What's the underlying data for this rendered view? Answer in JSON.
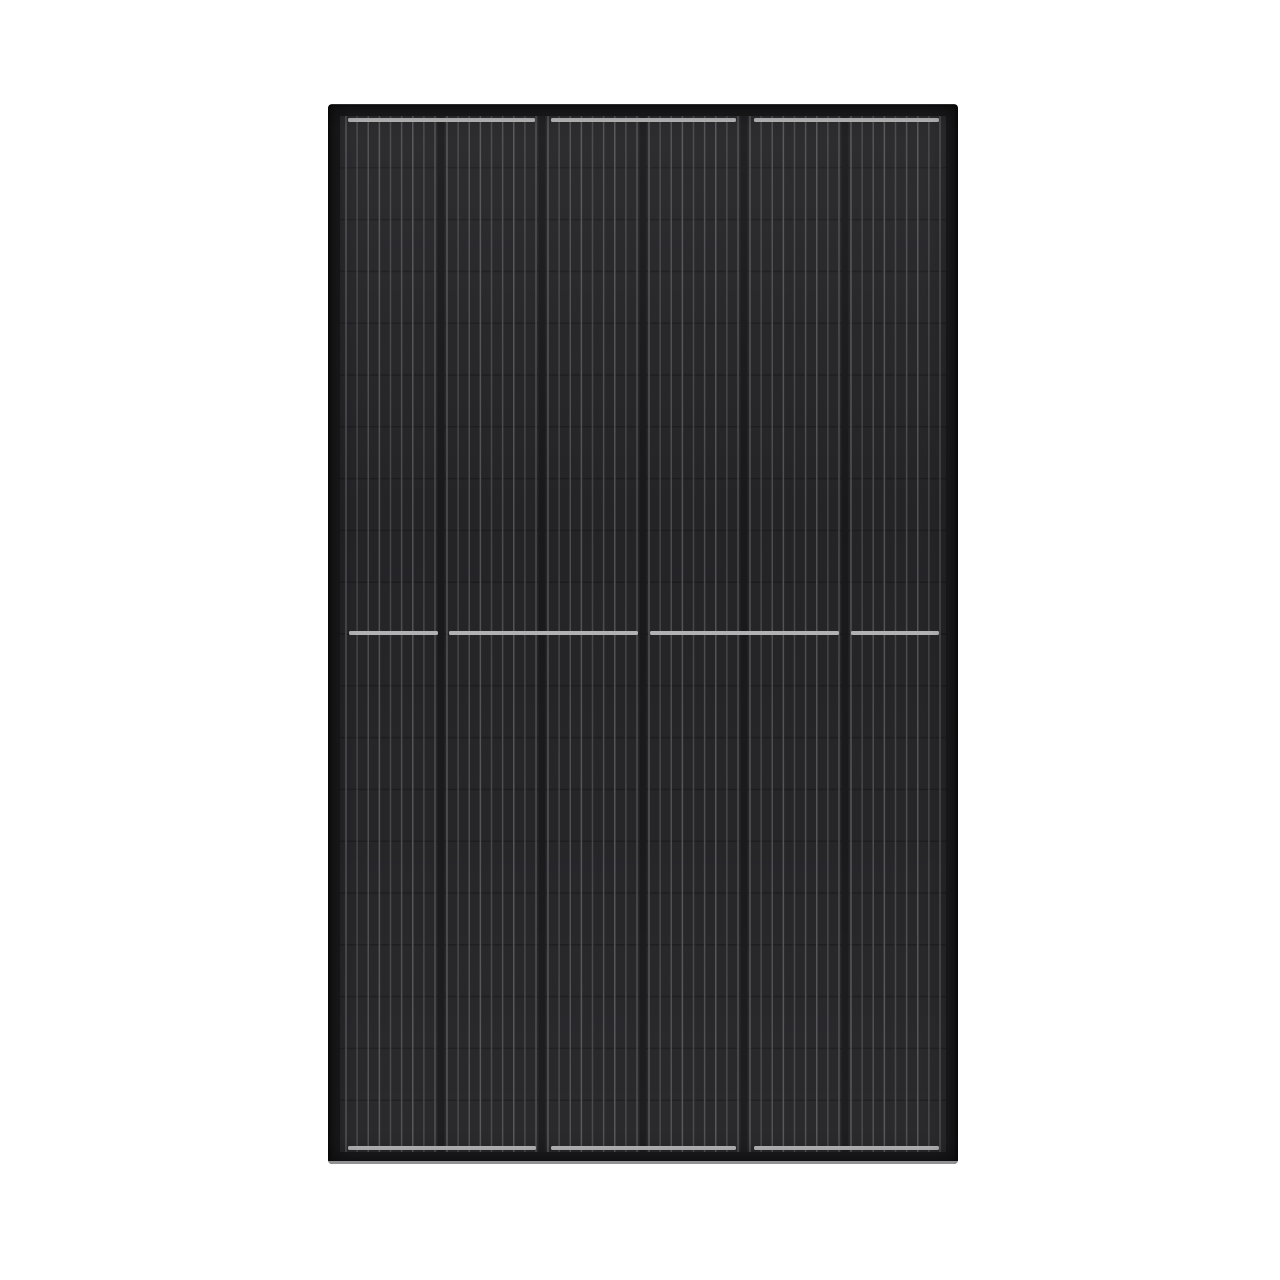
{
  "page": {
    "background_color": "#ffffff",
    "width": 1280,
    "height": 1280
  },
  "panel": {
    "subject": "all-black-solar-panel-module",
    "x": 328,
    "y": 104,
    "width": 630,
    "height": 1060,
    "frame_thickness": 12,
    "colors": {
      "frame": "#1b1b1d",
      "frame_bottom_bevel": "#919193",
      "cell": "#262629",
      "cell_column_gap": "#1a1a1c",
      "row_divider": "#1d1d20",
      "busbar": "#5e5e63",
      "ribbon": "#b7b7b9"
    },
    "grid": {
      "cell_columns": 6,
      "half_cell_rows": 20,
      "busbars_per_cell": 9,
      "column_gap_width": 7,
      "busbar_width": 1.5,
      "busbar_inset": 6,
      "busbar_opacities": [
        0.85,
        0.62,
        0.74
      ]
    },
    "ribbons": {
      "thickness": 4,
      "top_y": 14,
      "middle_y": 527,
      "bottom_y": 1042,
      "top_segments": [
        [
          20,
          207
        ],
        [
          223,
          408
        ],
        [
          426,
          611
        ]
      ],
      "middle_segments": [
        [
          21,
          110
        ],
        [
          121,
          310
        ],
        [
          322,
          511
        ],
        [
          523,
          611
        ]
      ],
      "bottom_segments": [
        [
          20,
          208
        ],
        [
          223,
          408
        ],
        [
          426,
          611
        ]
      ]
    }
  }
}
